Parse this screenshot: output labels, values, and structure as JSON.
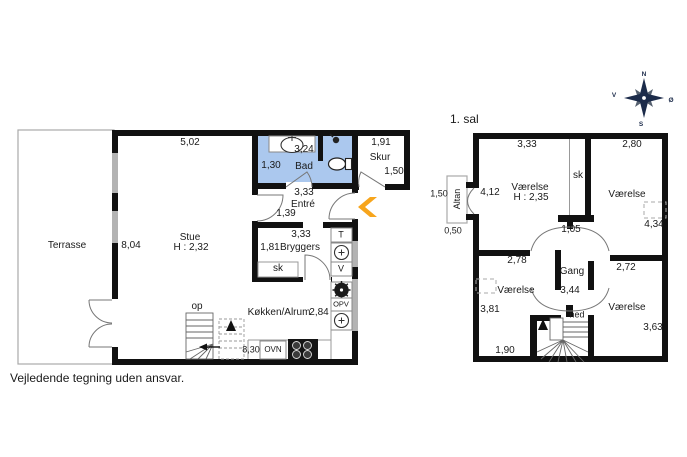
{
  "meta": {
    "footer": "Vejledende tegning uden ansvar."
  },
  "compass": {
    "n": "N",
    "e": "Ø",
    "s": "S",
    "w": "V"
  },
  "colors": {
    "wall": "#111111",
    "bathroom_fill": "#abc8ee",
    "window": "#b3b3b3",
    "entrance_arrow": "#f7a51c",
    "compass": "#1c2b4a"
  },
  "ground_floor": {
    "terrace": {
      "label": "Terrasse"
    },
    "dimensions": {
      "top_width": "5,02",
      "left_height": "8,04"
    },
    "living_room": {
      "label": "Stue",
      "ceiling": "H : 2,32"
    },
    "bathroom": {
      "label": "Bad",
      "width": "3,24",
      "depth": "1,30"
    },
    "shed": {
      "label": "Skur",
      "width": "1,91",
      "depth": "1,50"
    },
    "hall": {
      "label": "Entré",
      "width": "3,33",
      "depth": "1,39"
    },
    "utility": {
      "label": "Bryggers",
      "width": "3,33",
      "depth": "1,81",
      "closet": "sk"
    },
    "kitchen": {
      "label": "Køkken/Alrum",
      "width": "2,84",
      "bottom_width": "8,30"
    },
    "appliances": {
      "dryer": "T",
      "washer": "V",
      "dishwasher": "OPV",
      "oven": "OVN"
    },
    "stairs": {
      "label": "op"
    }
  },
  "first_floor": {
    "title": "1. sal",
    "balcony": {
      "label": "Altan",
      "height": "1,50",
      "width": "0,50"
    },
    "room_nw": {
      "label": "Værelse",
      "ceiling": "H : 2,35",
      "width": "3,33",
      "height": "4,12"
    },
    "closet": "sk",
    "room_ne": {
      "label": "Værelse",
      "width": "2,80",
      "height": "4,34"
    },
    "hallway": {
      "label": "Gang",
      "width": "1,05",
      "length": "3,44"
    },
    "room_sw": {
      "label": "Værelse",
      "width": "2,78",
      "height": "3,81",
      "bottom": "1,90"
    },
    "room_se": {
      "label": "Værelse",
      "width": "2,72",
      "height": "3,63"
    },
    "stairs": {
      "label": "ned"
    }
  }
}
